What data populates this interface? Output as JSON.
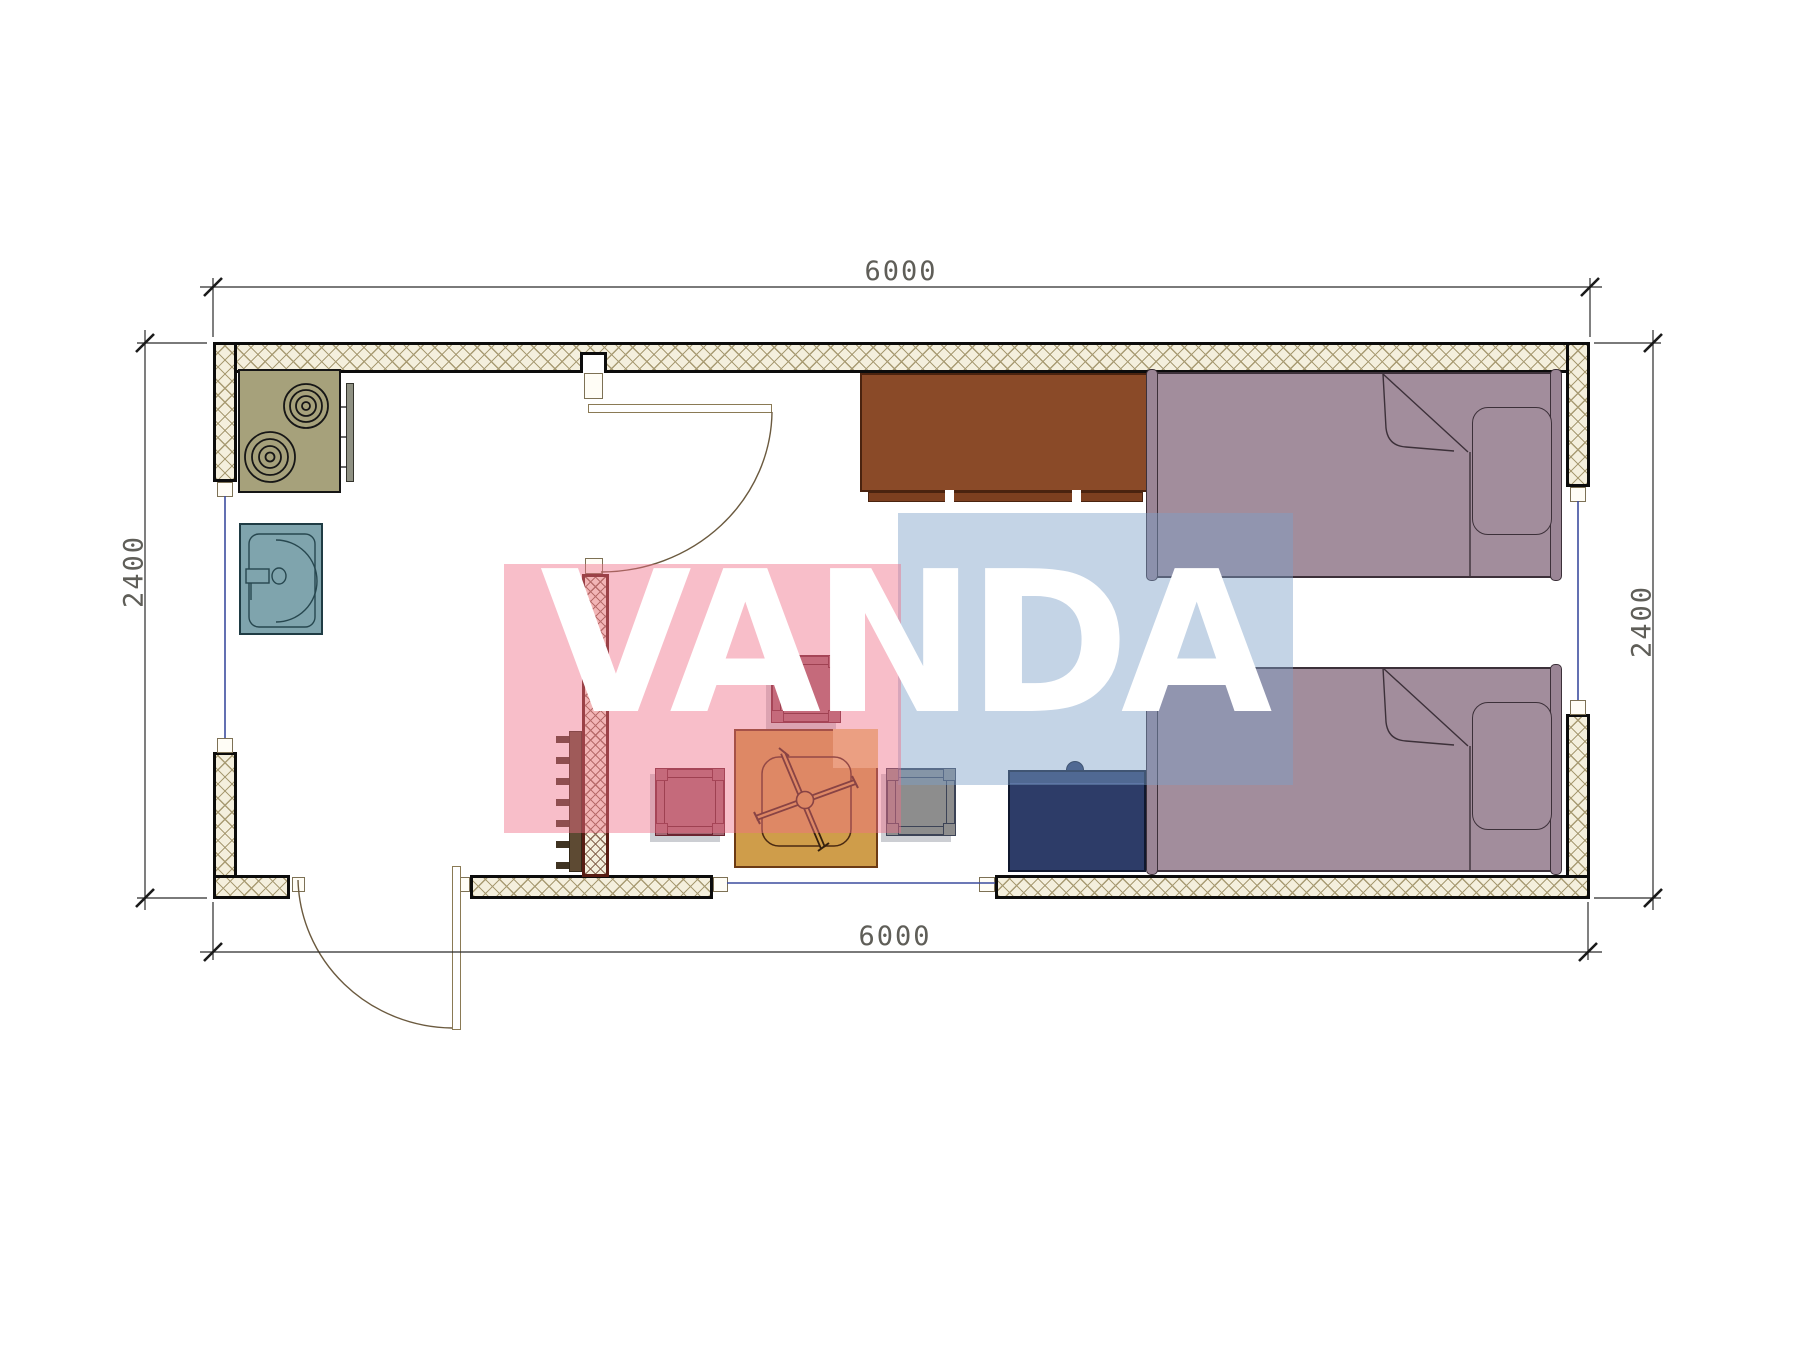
{
  "drawing": {
    "type": "architectural floor plan, top view, single module 6000 x 2400",
    "watermark": {
      "text": "VANDA",
      "pink": "#f06e87",
      "blue": "#7da0c8",
      "text_color": "#ffffff"
    },
    "dimensions": {
      "top": "6000",
      "bottom": "6000",
      "left": "2400",
      "right": "2400"
    },
    "furniture": [
      "stove-two-burners",
      "kitchen-counter-edge",
      "sink",
      "coat-rack",
      "interior-partition-wall",
      "top-door-with-swing",
      "entrance-door-with-swing",
      "wardrobe",
      "bed-upper",
      "bed-lower",
      "nightstand",
      "folding-table",
      "stool-top",
      "stool-left",
      "stool-right-gray",
      "window-left",
      "window-right",
      "window-bottom"
    ],
    "colors": {
      "wall_hatch_bg": "#f4efdd",
      "wall_hatch_line": "#a89b73",
      "wall_edge": "#0c0c0c",
      "partition_edge": "#571c13",
      "stove": "#a6a17b",
      "sink": "#7fa4ad",
      "wardrobe": "#8a4a28",
      "bed": "#a28d9c",
      "nightstand": "#2d3c68",
      "table": "#cf9d4a",
      "stool_mauve": "#a26671",
      "stool_gray": "#8d8d8d",
      "coat_rack": "#5d4a33",
      "window_line": "#3c4c9e",
      "dimension_text": "#44433c"
    }
  }
}
